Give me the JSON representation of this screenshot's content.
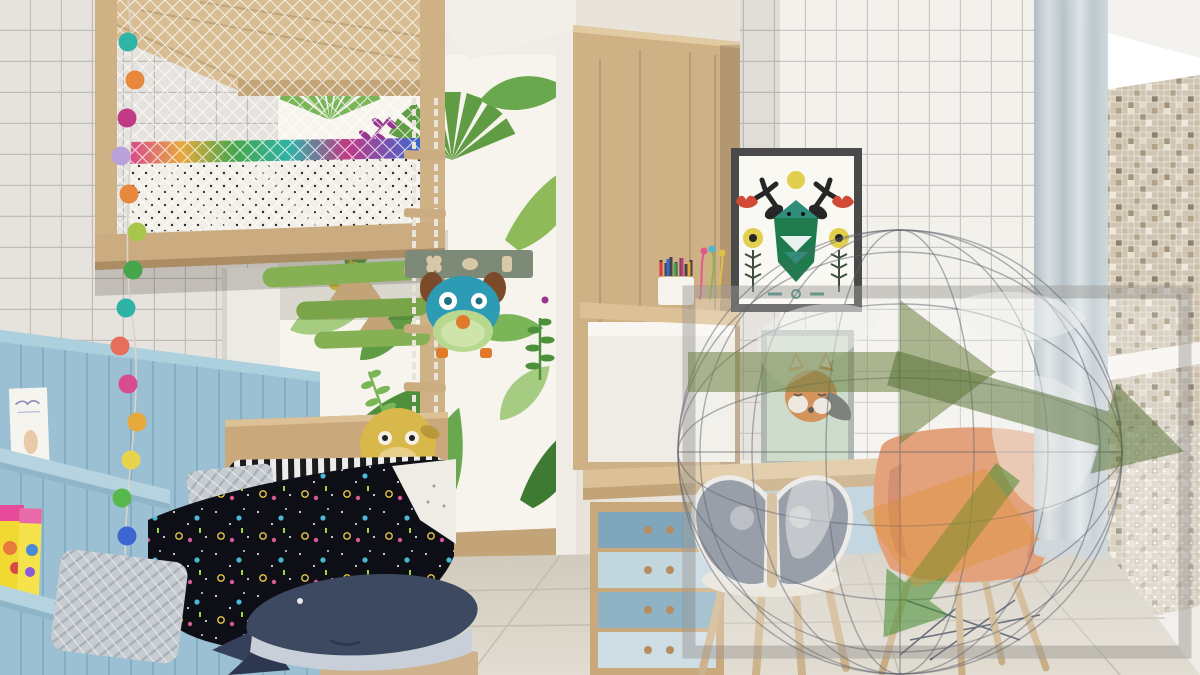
{
  "meta": {
    "type": "photorealistic 3D interior render",
    "description": "3D architectural rendering of a children's bedroom: white grid-tile walls, jungle leaf wallpaper, wooden house-frame loft bed with safety netting and pom-pom garland, blue plank wainscot with book ledges, platform bed with space-print duvet and whale plush, light-oak wardrobe and desk with blue drawers, butterfly chair and orange shell chair, folk-art deer and fox posters, sheer curtain and beige mosaic wall, large translucent globe-and-arrows watermark overlay on the right half."
  },
  "scene": {
    "walls": {
      "left_wall": "white square grid tiles with grey grout",
      "back_wall": "white jungle wallpaper with green tropical leaves and purple sprigs",
      "desk_wall": "white square grid tiles",
      "right_wall": "beige and taupe glass mosaic tiles",
      "wainscot": "light blue vertical wood planks with ledge rails"
    },
    "objects": [
      {
        "name": "loft-bed",
        "description": "house-shaped natural wood loft frame with white net mesh, polka-dot mattress and multicolour blanket trim"
      },
      {
        "name": "leaf-steps",
        "description": "green leaf-shaped climbing steps on wooden brackets under the loft"
      },
      {
        "name": "rope-ladder",
        "description": "white rope ladder with wooden rungs"
      },
      {
        "name": "pompom-garland",
        "description": "vertical string of multicolour felt pom-poms"
      },
      {
        "name": "book-ledges",
        "description": "blue wall ledges holding a white storybook and yellow comic books"
      },
      {
        "name": "door",
        "description": "white interior door with metal handle"
      },
      {
        "name": "coat-rack",
        "description": "grey-green wall rack with hooks holding a teal dog-face backpack with orange nose"
      },
      {
        "name": "bed",
        "description": "low platform bed, wooden headboard, yellow dog plush, striped roll pillow, grey knitted pillows, black space-print duvet, navy whale plush"
      },
      {
        "name": "wardrobe",
        "description": "tall light-oak wardrobe column with white desk-hutch niche, pencil cup and wire flowers"
      },
      {
        "name": "desk",
        "description": "light wood desktop across the wall with light-blue drawer fronts and a four-drawer blue cabinet with twin wooden knobs"
      },
      {
        "name": "deer-poster",
        "description": "black-framed folk-art poster: teal geometric deer head, antlers, yellow sun, red tulips, yellow flowers"
      },
      {
        "name": "fox-poster",
        "description": "grey-framed poster of an orange fox head on sage green"
      },
      {
        "name": "butterfly-chair",
        "description": "wooden stool chair with large grey butterfly-shaped backrest"
      },
      {
        "name": "shell-chair",
        "description": "orange Eames-style shell armchair with wooden dowel legs and wire struts"
      },
      {
        "name": "curtain",
        "description": "sheer grey-blue floor curtain"
      },
      {
        "name": "mosaic-wall",
        "description": "beige mosaic wall with white crown moulding, white shelf and shimmer panel"
      },
      {
        "name": "floor",
        "description": "large beige floor tiles; light wood platform deck under the bed"
      }
    ],
    "garland": {
      "colors": [
        "#2fb3a6",
        "#e8883c",
        "#c03a86",
        "#b9a2dc",
        "#e8883c",
        "#a9c64c",
        "#47a64b",
        "#2fb3a6",
        "#e86e5c",
        "#d84b8e",
        "#e8a93c",
        "#e8d44c",
        "#57b84c",
        "#3a68d0",
        "#d83c3c",
        "#e8883c"
      ]
    },
    "watermark": {
      "description": "semi-transparent rectangular watermark: wireframe globe with pale continents plus olive, green and orange arrows, grey border",
      "border_color": "rgba(120,118,112,0.35)",
      "arrow_colors": [
        "#6b8040",
        "#4e692c",
        "#3f8a2c",
        "#e09030"
      ]
    }
  },
  "palette": {
    "wood_light": "#d2b68c",
    "wood_mid": "#c3a478",
    "tile_white": "#f3f1ec",
    "grout_grey": "#c9c7c2",
    "panel_blue": "#9cc0d3",
    "ledge_blue": "#b6d4e0",
    "leaf_green_dark": "#3f7a33",
    "leaf_green_mid": "#5f9c43",
    "leaf_green_light": "#a6cc82",
    "sprig_purple": "#97368f",
    "duvet_black": "#0e0e16",
    "whale_navy": "#3c4960",
    "fox_orange": "#c8742f",
    "deer_teal": "#2f8f7a",
    "chair_orange": "#dd8858",
    "butterfly_grey": "#7b8590",
    "mosaic_beige": "#cfc5b2",
    "floor_beige": "#d9d3c6",
    "curtain_grey": "#c6d0d5"
  }
}
